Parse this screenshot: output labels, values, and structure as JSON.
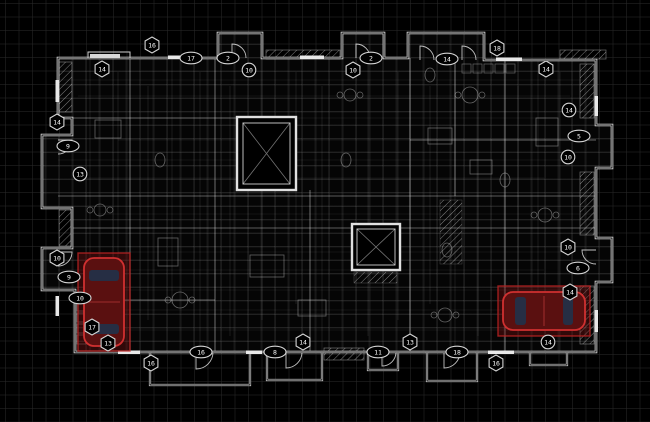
{
  "drawing": {
    "kind": "architectural-floor-plan",
    "colors": {
      "background": "#000000",
      "grid_line": "#272727",
      "wall": "#e8e8e8",
      "faint_linework": "#8b9096",
      "callout_stroke": "#d4d4d4",
      "callout_fill": "#000000",
      "callout_text": "#ffffff",
      "highlight_red": "#d03030",
      "car_body_fill": "#5a1010",
      "car_window": "#20324a"
    }
  },
  "callouts": [
    {
      "shape": "hex",
      "label": "14",
      "x": 102,
      "y": 69
    },
    {
      "shape": "hex",
      "label": "16",
      "x": 152,
      "y": 45
    },
    {
      "shape": "oval",
      "label": "17",
      "x": 191,
      "y": 58
    },
    {
      "shape": "oval",
      "label": "2",
      "x": 228,
      "y": 58
    },
    {
      "shape": "circle",
      "label": "10",
      "x": 249,
      "y": 70
    },
    {
      "shape": "hex",
      "label": "10",
      "x": 353,
      "y": 70
    },
    {
      "shape": "oval",
      "label": "2",
      "x": 371,
      "y": 58
    },
    {
      "shape": "oval",
      "label": "14",
      "x": 447,
      "y": 59
    },
    {
      "shape": "hex",
      "label": "18",
      "x": 497,
      "y": 48
    },
    {
      "shape": "hex",
      "label": "14",
      "x": 546,
      "y": 69
    },
    {
      "shape": "hex",
      "label": "14",
      "x": 57,
      "y": 122
    },
    {
      "shape": "oval",
      "label": "9",
      "x": 68,
      "y": 146
    },
    {
      "shape": "circle",
      "label": "13",
      "x": 80,
      "y": 174
    },
    {
      "shape": "hex",
      "label": "10",
      "x": 57,
      "y": 258
    },
    {
      "shape": "oval",
      "label": "9",
      "x": 69,
      "y": 277
    },
    {
      "shape": "oval",
      "label": "10",
      "x": 80,
      "y": 298
    },
    {
      "shape": "hex",
      "label": "17",
      "x": 92,
      "y": 327
    },
    {
      "shape": "hex",
      "label": "13",
      "x": 108,
      "y": 343
    },
    {
      "shape": "circle",
      "label": "14",
      "x": 569,
      "y": 110
    },
    {
      "shape": "oval",
      "label": "5",
      "x": 579,
      "y": 136
    },
    {
      "shape": "circle",
      "label": "10",
      "x": 568,
      "y": 157
    },
    {
      "shape": "hex",
      "label": "10",
      "x": 568,
      "y": 247
    },
    {
      "shape": "oval",
      "label": "6",
      "x": 578,
      "y": 268
    },
    {
      "shape": "hex",
      "label": "14",
      "x": 570,
      "y": 292
    },
    {
      "shape": "hex",
      "label": "16",
      "x": 151,
      "y": 363
    },
    {
      "shape": "oval",
      "label": "16",
      "x": 201,
      "y": 352
    },
    {
      "shape": "oval",
      "label": "8",
      "x": 275,
      "y": 352
    },
    {
      "shape": "hex",
      "label": "14",
      "x": 303,
      "y": 342
    },
    {
      "shape": "oval",
      "label": "11",
      "x": 378,
      "y": 352
    },
    {
      "shape": "hex",
      "label": "13",
      "x": 410,
      "y": 342
    },
    {
      "shape": "oval",
      "label": "18",
      "x": 457,
      "y": 352
    },
    {
      "shape": "hex",
      "label": "16",
      "x": 496,
      "y": 363
    },
    {
      "shape": "circle",
      "label": "14",
      "x": 548,
      "y": 342
    }
  ],
  "highlighted_cars": [
    {
      "name": "car-bottom-left",
      "x": 104,
      "y": 302,
      "w": 40,
      "h": 88,
      "rotation": 0
    },
    {
      "name": "car-bottom-right",
      "x": 544,
      "y": 311,
      "w": 38,
      "h": 82,
      "rotation": -90
    }
  ]
}
